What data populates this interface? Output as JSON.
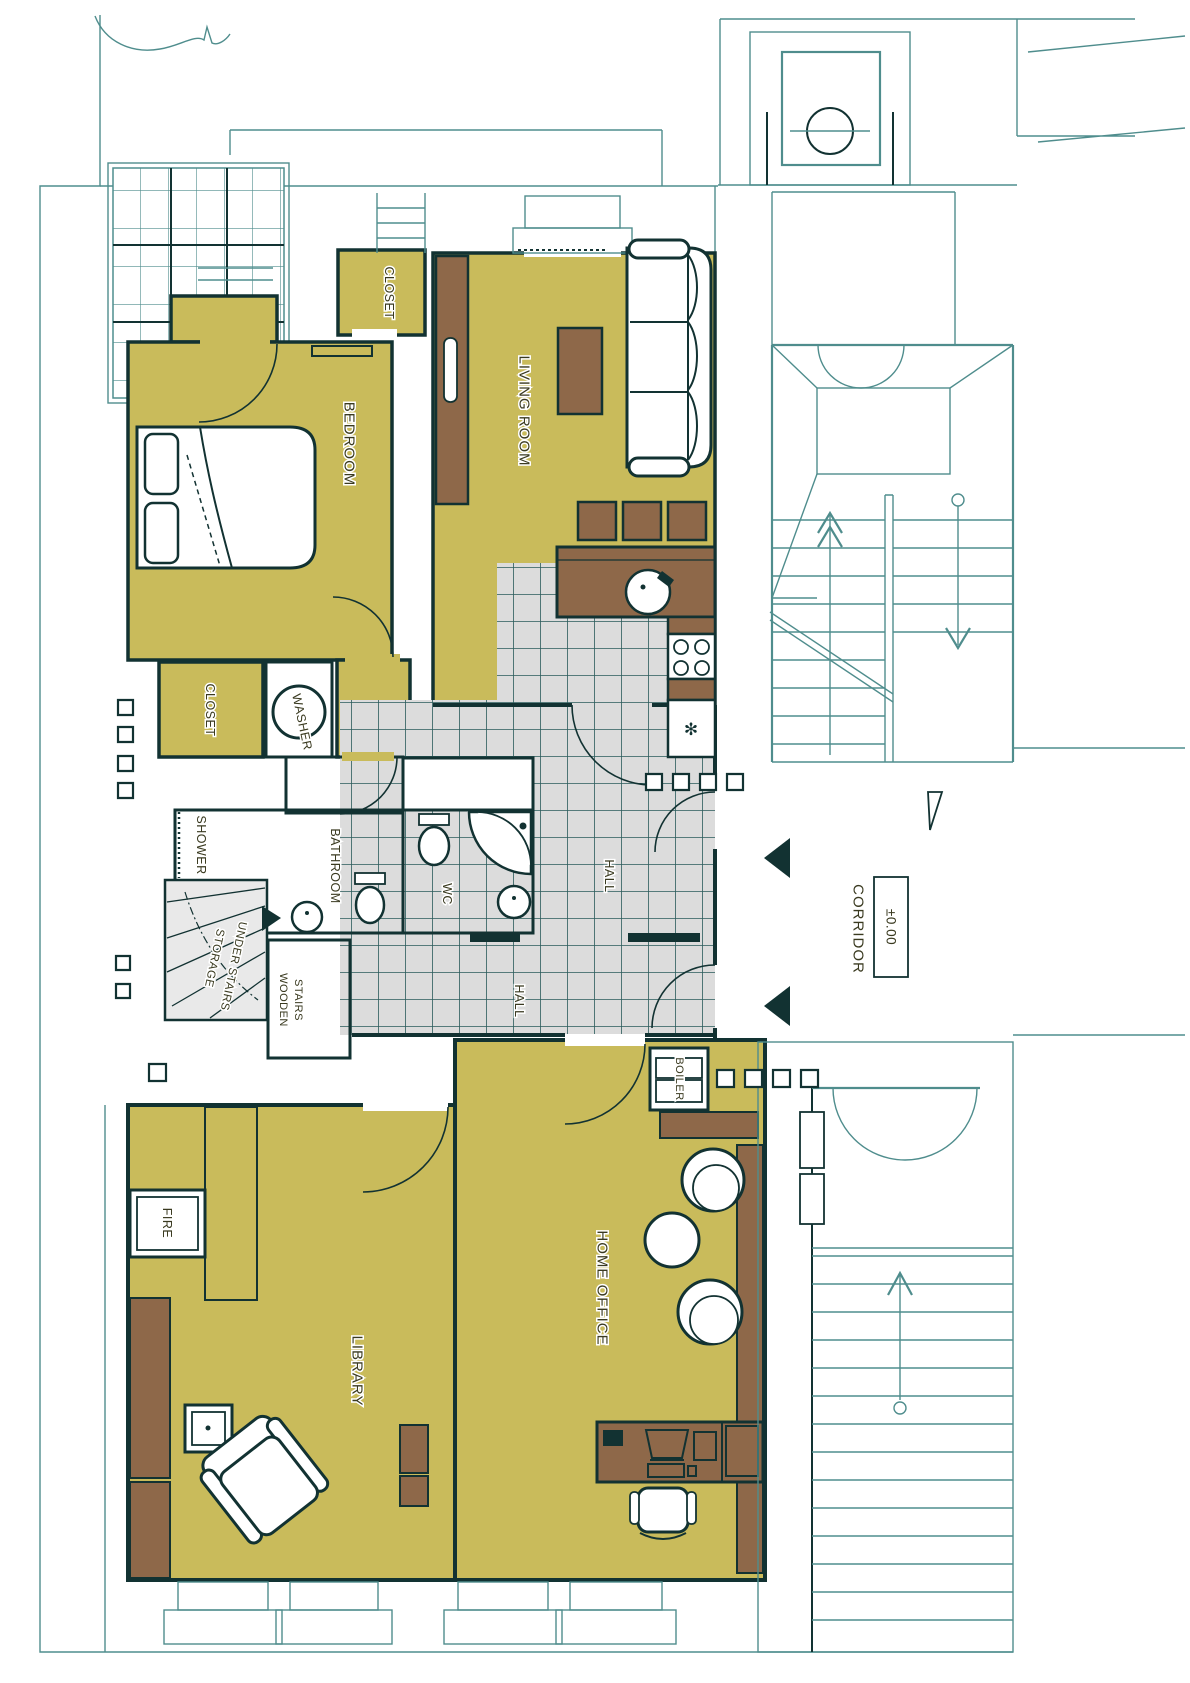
{
  "floor_plan": {
    "rooms": {
      "closet_top": "CLOSET",
      "bedroom": "BEDROOM",
      "living_room": "LIVING ROOM",
      "closet_side": "CLOSET",
      "washer": "WASHER",
      "shower": "SHOWER",
      "bathroom": "BATHROOM",
      "wc": "WC",
      "hall_upper": "HALL",
      "hall_lower": "HALL",
      "storage_line1": "STORAGE",
      "storage_line2": "UNDER STAIRS",
      "wooden_stairs_line1": "WOODEN",
      "wooden_stairs_line2": "STAIRS",
      "boiler": "BOILER",
      "corridor": "CORRIDOR",
      "library": "LIBRARY",
      "home_office": "HOME OFFICE",
      "fireplace": "FIRE"
    },
    "annotations": {
      "level_mark": "±0.00"
    },
    "icons": {
      "freezer_snowflake": "✻"
    },
    "colors": {
      "room_fill": "#c9bb5b",
      "furniture": "#8e6849",
      "tile_light": "#dcdcdc",
      "tile_dark": "#a8a8a8",
      "storage_fill": "#e9e9e9",
      "wall": "#123232",
      "grid": "#2a5b5b",
      "line": "#4f8d8d",
      "text": "#3a3a20"
    }
  }
}
